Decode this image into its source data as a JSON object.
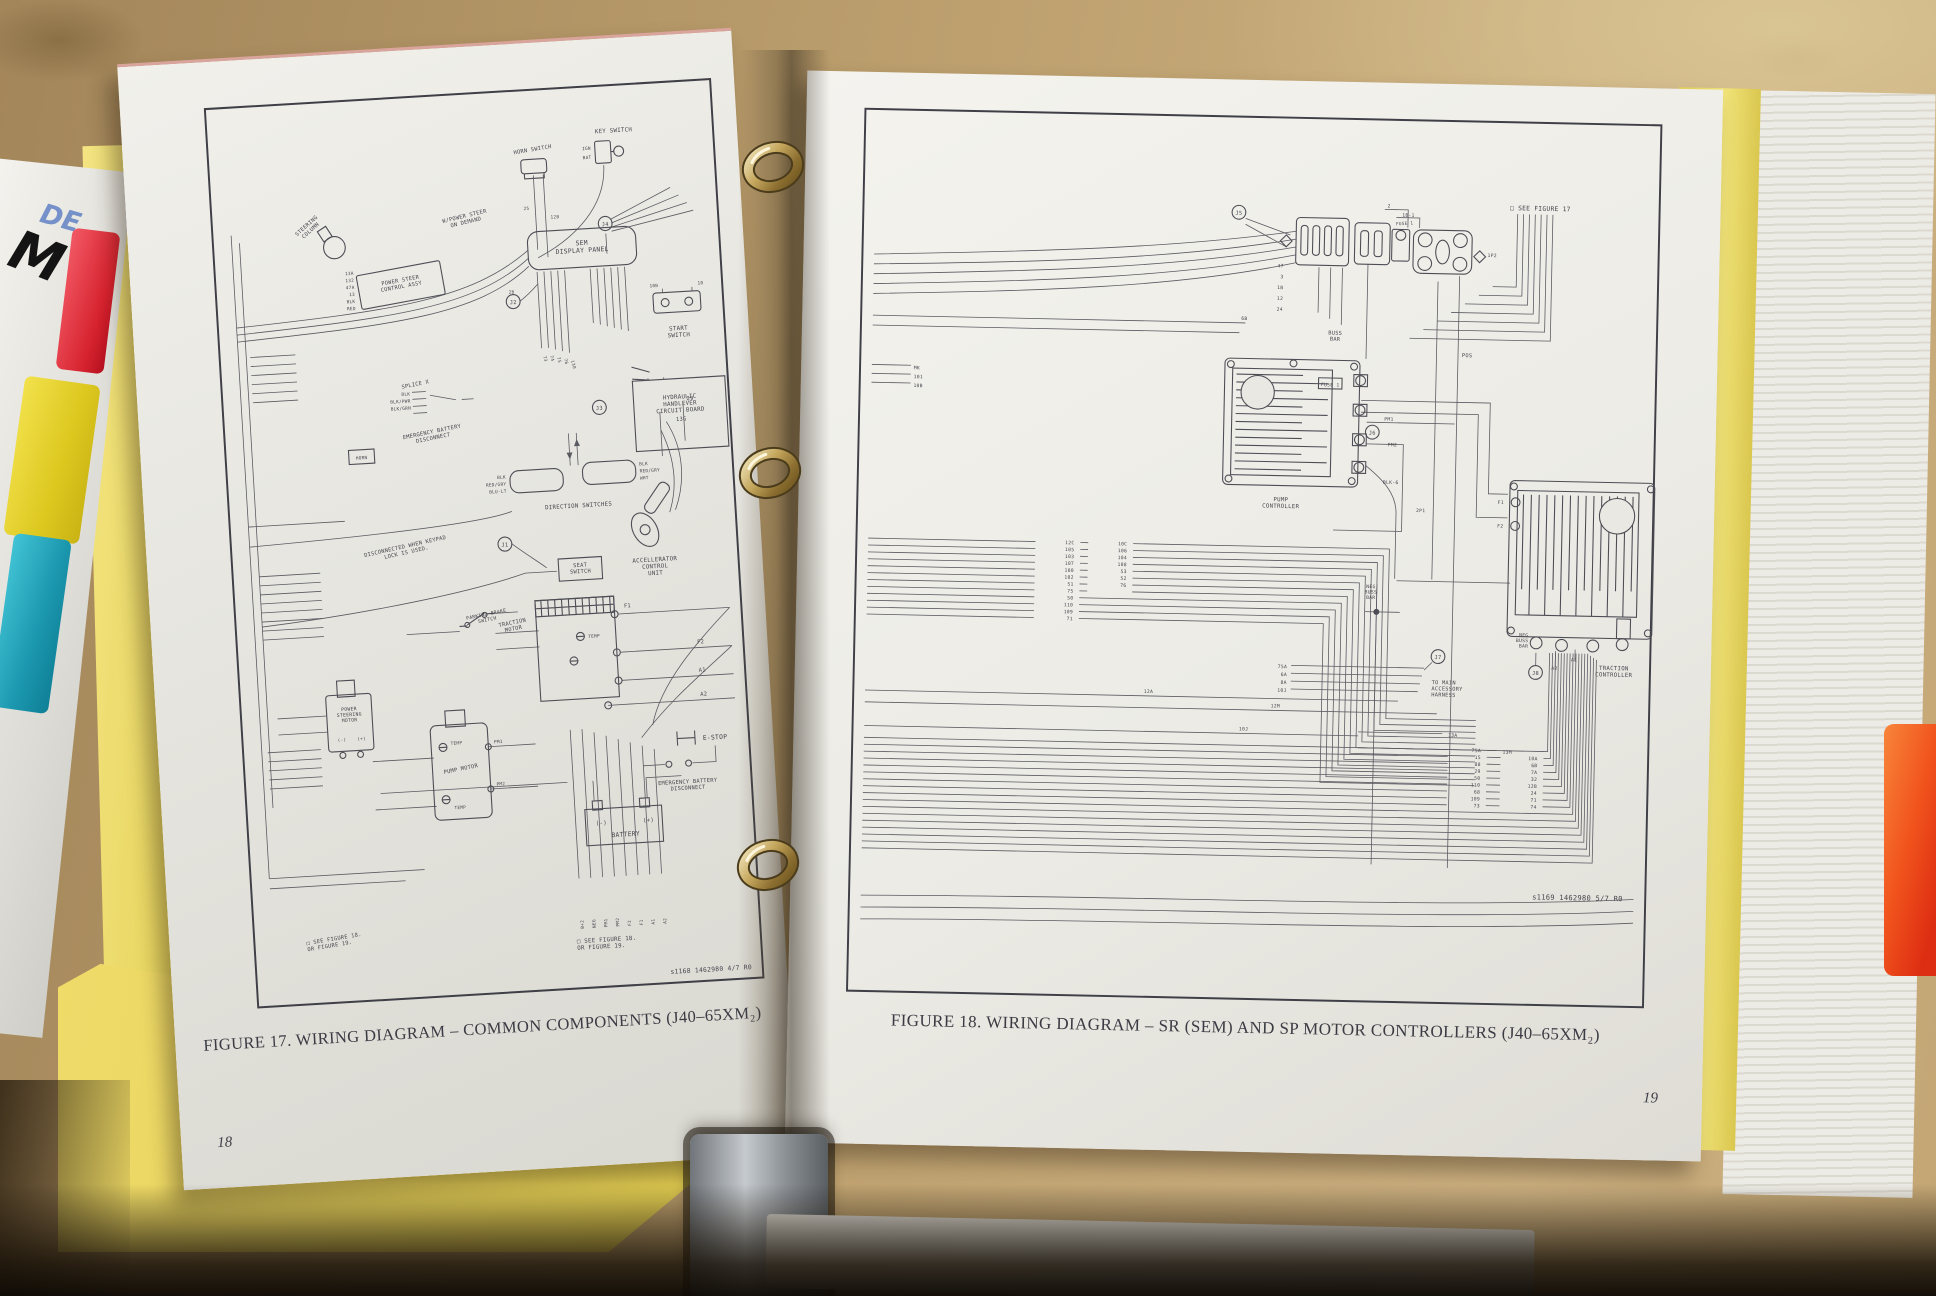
{
  "binder": {
    "cover_pen_text": "DE",
    "cover_marker_text": "M",
    "colors": {
      "divider_yellow": "#ecdc6a",
      "tab_red": "#d6232f",
      "tab_yellow": "#ddc81f",
      "tab_cyan": "#1b97ae",
      "tab_orange": "#f1541d",
      "ring_gold": "#c4a65c"
    }
  },
  "left_page": {
    "number": "18",
    "caption": "FIGURE 17. WIRING DIAGRAM – COMMON COMPONENTS (J40–65XM₂)",
    "doc_code": "s1168 1462980 4/7 R0",
    "notes": {
      "bottom_left": "□ SEE FIGURE 18.\nOR FIGURE 19.",
      "bottom_right": "□ SEE FIGURE 18.\nOR FIGURE 19.",
      "keypad": "DISCONNECTED WHEN KEYPAD\nLOCK IS USED.",
      "power_steer": "W/POWER STEER\nON DEMAND"
    },
    "components": {
      "horn_switch": "HORN SWITCH",
      "key_switch": "KEY SWITCH",
      "key_ign": "IGN",
      "key_bat": "BAT",
      "steering_column": "STEERING\nCOLUMN",
      "power_steer_assy": "POWER STEER\nCONTROL ASSY",
      "sem_display_panel": "SEM\nDISPLAY PANEL",
      "start_switch": "START\nSWITCH",
      "hydraulic_board": "HYDRAULIC\nHANDLEVER\nCIRCUIT BOARD",
      "splice": "SPLICE X",
      "emergency_batt_mid": "EMERGENCY BATTERY\nDISCONNECT",
      "horn": "HORN",
      "direction_switches": "DIRECTION SWITCHES",
      "accelerator": "ACCELLERATOR\nCONTROL\nUNIT",
      "seat_switch": "SEAT\nSWITCH",
      "parking_brake": "PARKING BRAKE\nSWITCH",
      "traction_motor": "TRACTION\nMOTOR",
      "power_steering_motor": "POWER\nSTEERING\nMOTOR",
      "pump_motor": "PUMP MOTOR",
      "battery": "BATTERY",
      "neg": "(-)",
      "pos": "(+)",
      "e_stop": "E-STOP",
      "emergency_batt_bottom": "EMERGENCY BATTERY\nDISCONNECT"
    },
    "connectors": [
      "J1",
      "J2",
      "J3",
      "J4"
    ],
    "terminals": {
      "f1": "F1",
      "f2": "F2",
      "a1": "A1",
      "a2": "A2",
      "pm1": "PM1",
      "pm2": "PM2",
      "temp": "TEMP"
    },
    "horn_tags": [
      "25",
      "12B"
    ],
    "sem_tag": "2B",
    "start_tags": [
      "10B",
      "10"
    ],
    "assy_tags": [
      "13A",
      "132",
      "47A",
      "13",
      "BLK",
      "RED"
    ],
    "splice_tags": [
      "BLK",
      "BLK/PWR",
      "BLK/GRN"
    ],
    "dir_tags": [
      "BLK",
      "RED/GRY",
      "BLU-LT",
      "BLK",
      "RED/GRY",
      "WHT"
    ],
    "arrow_tags": [
      "29",
      "13G"
    ],
    "fan_tags": [
      "73",
      "74",
      "75",
      "76",
      "130"
    ],
    "bottom_tags": [
      "B+2",
      "NEG",
      "PM1",
      "PM2",
      "F2",
      "F1",
      "A1",
      "A2"
    ]
  },
  "right_page": {
    "number": "19",
    "caption": "FIGURE 18. WIRING DIAGRAM – SR (SEM) AND SP MOTOR CONTROLLERS (J40–65XM₂)",
    "doc_code": "s1169 1462980 5/7 R0",
    "notes": {
      "top_right": "□ SEE FIGURE 17"
    },
    "components": {
      "pump_controller": "PUMP\nCONTROLLER",
      "traction_controller": "TRACTION\nCONTROLLER",
      "buss_bar": "BUSS\nBAR",
      "neg_buss_bar": "NEG\nBUSS\nBAR",
      "neg_buss_bar2": "NEG\nBUSS\nBAR",
      "fuse": "FUSE 1",
      "to_main": "TO MAIN\nACCESSORY\nHARNESS",
      "pos": "POS",
      "blk6": "BLK-6"
    },
    "connectors": [
      "J5",
      "J6",
      "J7",
      "J8"
    ],
    "terminals": {
      "f1": "F1",
      "f2": "F2",
      "a1": "A1",
      "a2": "A2",
      "pm1": "PM1",
      "pm2": "PM2",
      "p1": "2P1",
      "p2": "1P2"
    },
    "top_tags": [
      "2",
      "1B-1",
      "47",
      "3",
      "1B",
      "12",
      "24",
      "6B"
    ],
    "mid_tags": [
      "12A",
      "12M",
      "13A",
      "13M",
      "10J",
      "MK",
      "101",
      "10B"
    ],
    "bundle1_left": [
      "12C",
      "105",
      "103",
      "107",
      "100",
      "102",
      "51",
      "75"
    ],
    "bundle1_right": [
      "10C",
      "106",
      "104",
      "108",
      "53",
      "52",
      "76"
    ],
    "bundle1_tail": [
      "50",
      "110",
      "109",
      "71"
    ],
    "accessory_tags": [
      "75A",
      "6A",
      "8A",
      "10J"
    ],
    "bundle2_left": [
      "75A",
      "15",
      "88",
      "29",
      "50",
      "110",
      "68",
      "109",
      "73"
    ],
    "bundle2_right": [
      "10A",
      "6B",
      "7A",
      "32",
      "12B",
      "24",
      "71",
      "74"
    ]
  }
}
